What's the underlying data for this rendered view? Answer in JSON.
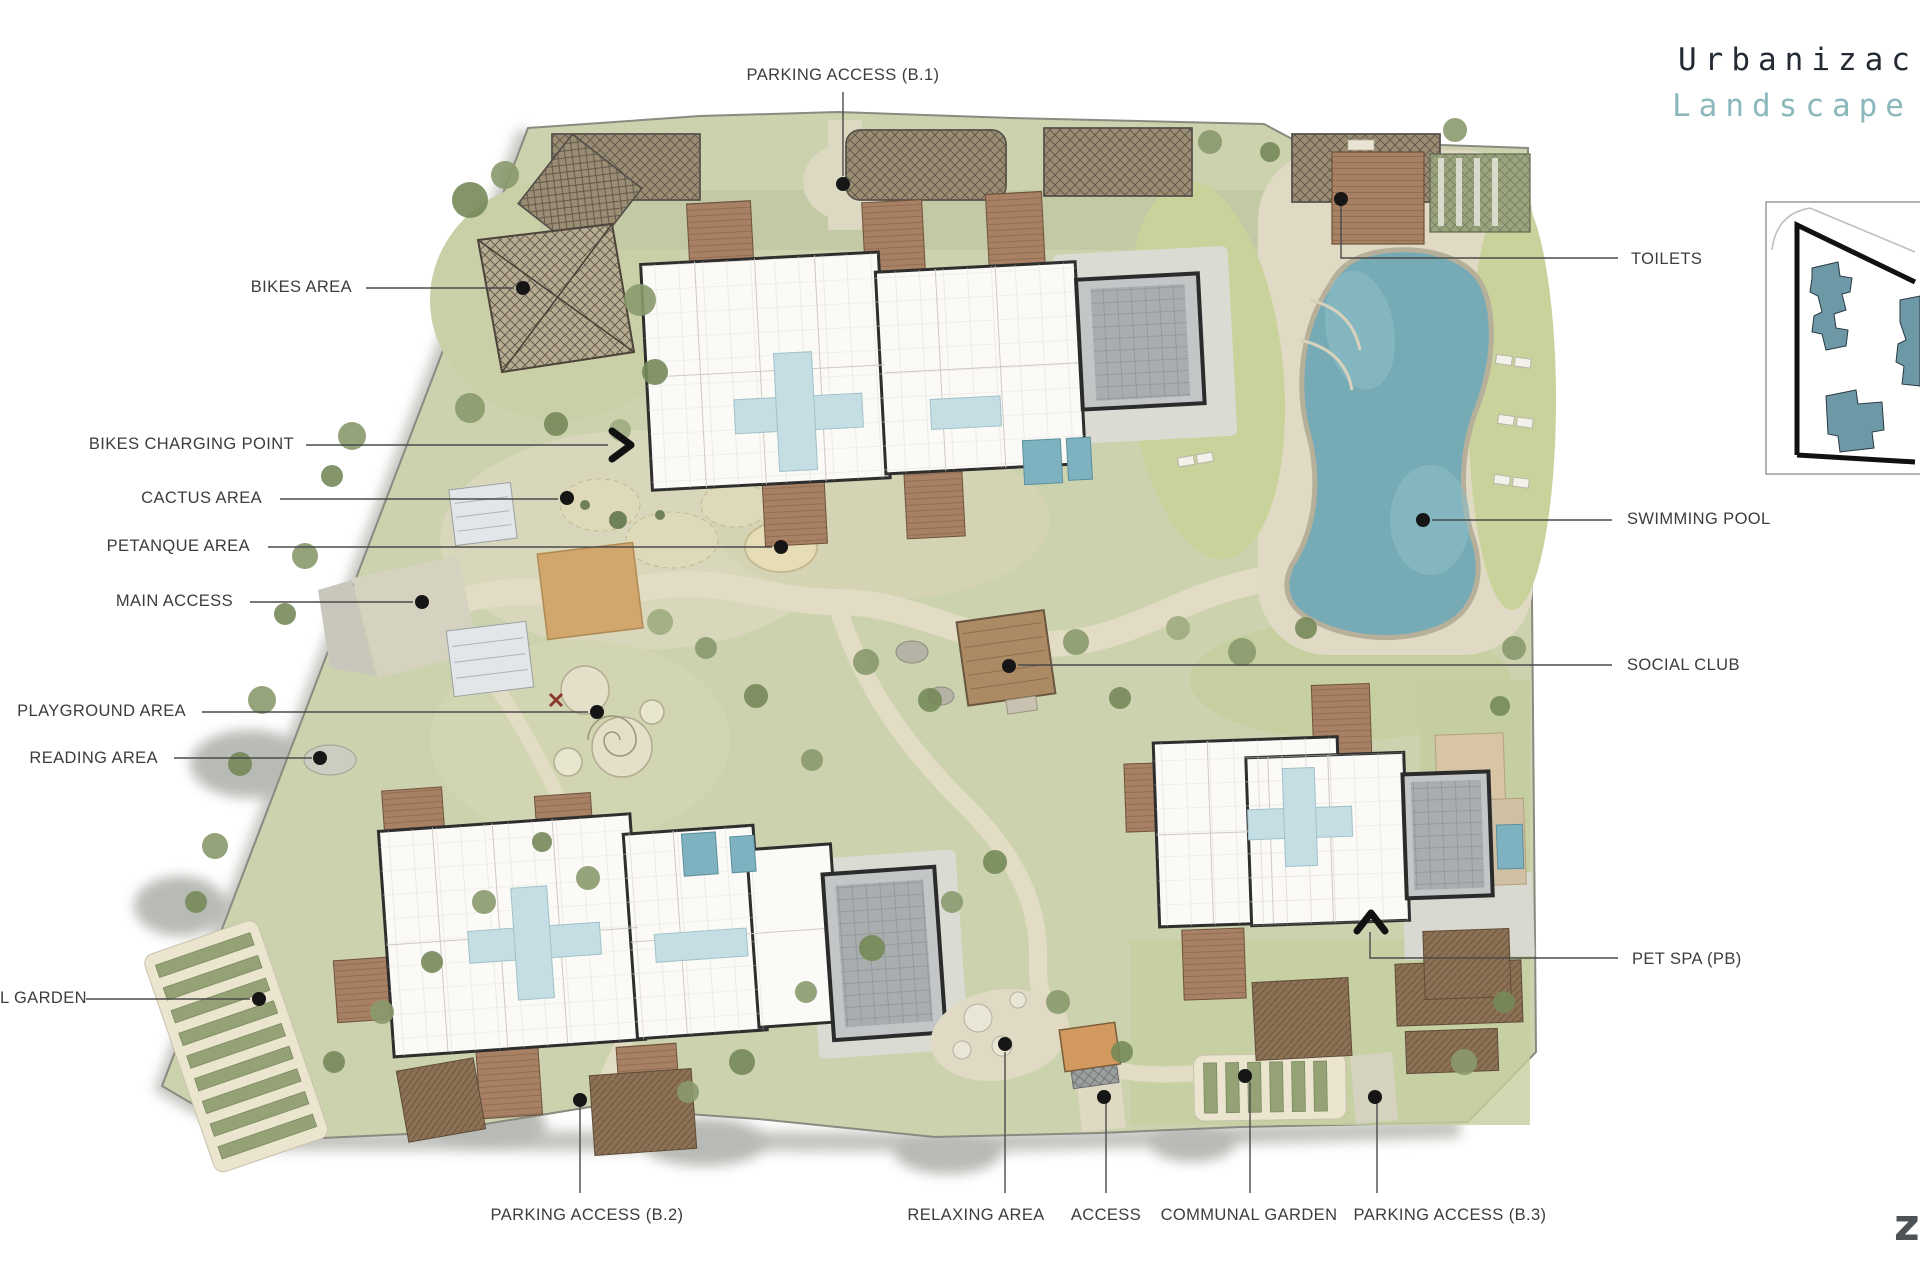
{
  "title": {
    "line1": "Urbanizac",
    "line2": "Landscape"
  },
  "plan_labels": {
    "parking_access_b1": "PARKING ACCESS (B.1)",
    "bikes_area": "BIKES AREA",
    "bikes_charging_point": "BIKES CHARGING POINT",
    "cactus_area": "CACTUS AREA",
    "petanque_area": "PETANQUE AREA",
    "main_access": "MAIN ACCESS",
    "playground_area": "PLAYGROUND AREA",
    "reading_area": "READING AREA",
    "garden_left_cut": "L GARDEN",
    "parking_access_b2": "PARKING ACCESS (B.2)",
    "relaxing_area": "RELAXING AREA",
    "access": "ACCESS",
    "communal_garden": "COMMUNAL GARDEN",
    "parking_access_b3": "PARKING ACCESS (B.3)",
    "toilets": "TOILETS",
    "swimming_pool": "SWIMMING POOL",
    "social_club": "SOCIAL CLUB",
    "pet_spa": "PET SPA (PB)"
  },
  "watermark": "z",
  "colors": {
    "title": "#232a33",
    "subtitle_teal": "#8cb8bc",
    "label_text": "#3c3c3c",
    "leader_line": "#4a4a4a",
    "site_green": "#ccd1ae",
    "lawn_green": "#c9d29b",
    "path_beige": "#e2dcc5",
    "pool_teal": "#76abb6",
    "building_white": "#fbfaf7",
    "roof_gray": "#b9bcbd",
    "deck_brown": "#a88165",
    "plaza_tan": "#d2a76e",
    "keyplan_building_teal": "#6d98a6"
  }
}
